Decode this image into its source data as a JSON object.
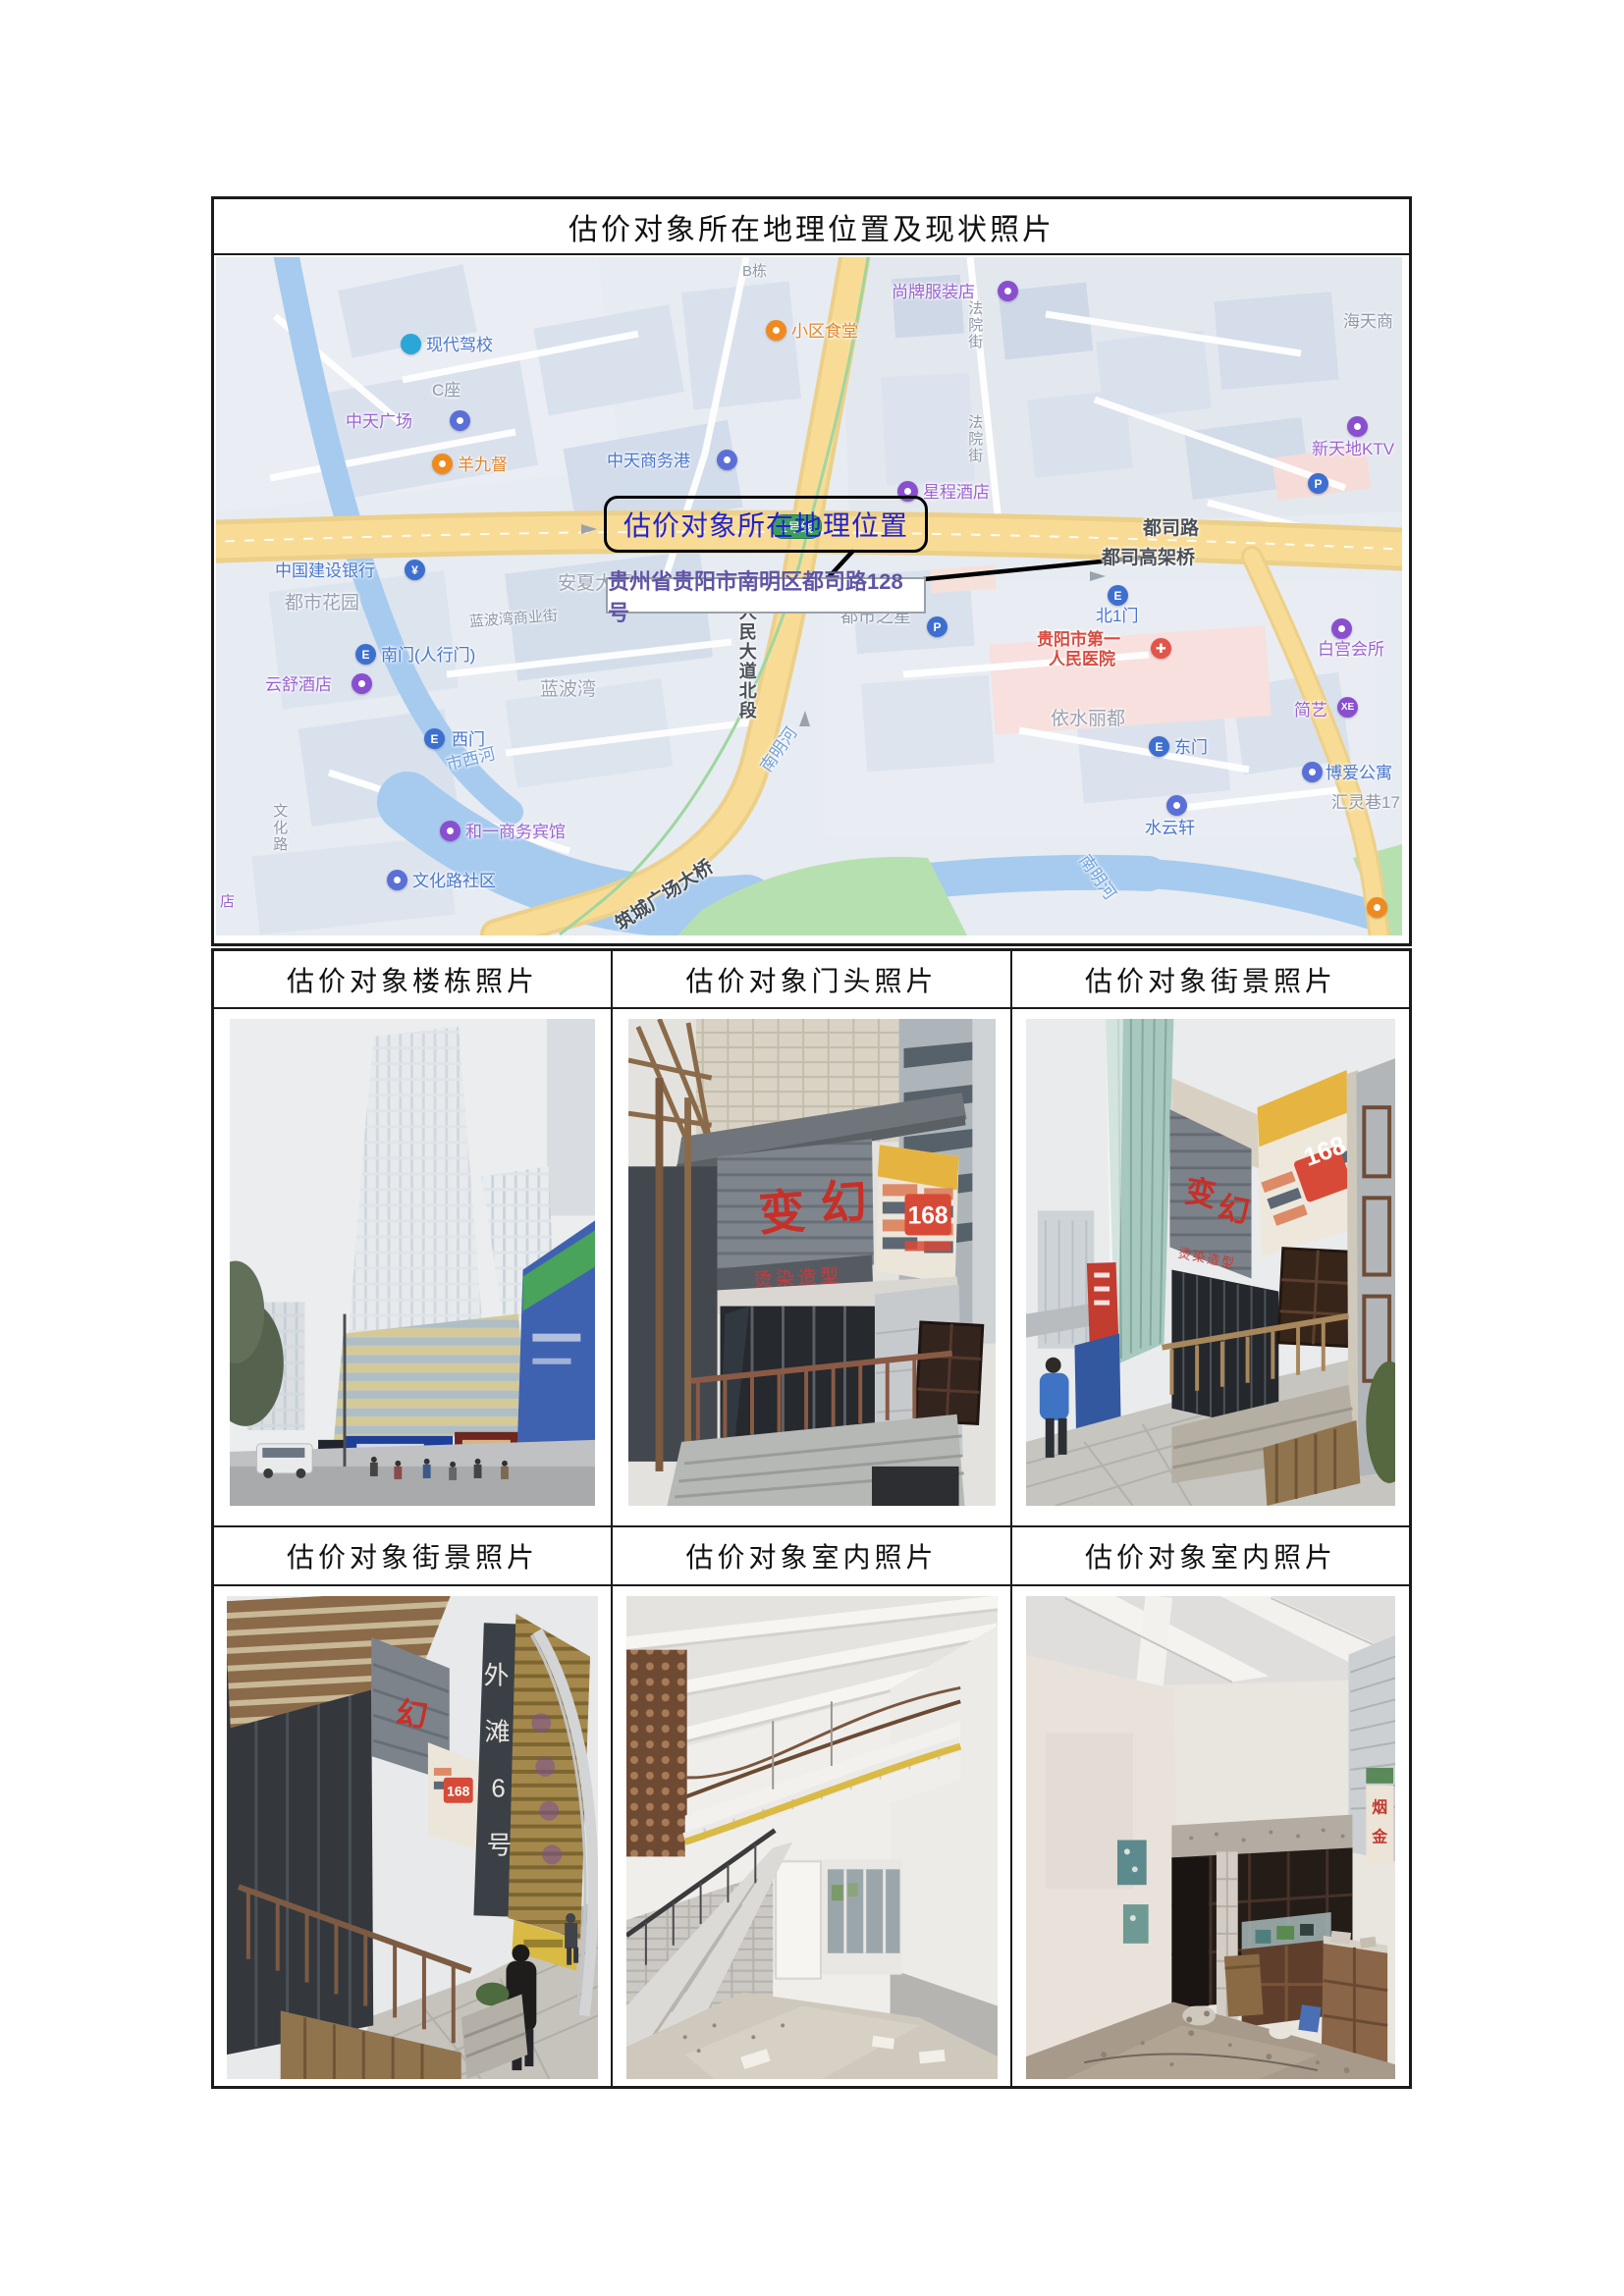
{
  "document": {
    "main_header": "估价对象所在地理位置及现状照片",
    "grid_headers_row1": [
      "估价对象楼栋照片",
      "估价对象门头照片",
      "估价对象街景照片"
    ],
    "grid_headers_row2": [
      "估价对象街景照片",
      "估价对象室内照片",
      "估价对象室内照片"
    ]
  },
  "map": {
    "callout_text": "估价对象所在地理位置",
    "pin_address": "贵州省贵阳市南明区都司路128号",
    "metro_badge": "1号线",
    "badge_xe": "XE",
    "badge_p": "P",
    "cross": "✚",
    "labels": {
      "xiandaijiaxiao": "现代驾校",
      "bdong": "B栋",
      "shangpai": "尚牌服装店",
      "xiaoqushitang": "小区食堂",
      "haitianshang": "海天商",
      "fayuanjie1": "法院街",
      "fayuanjie2": "法院街",
      "czuo": "C座",
      "zhongtianguangchang": "中天广场",
      "yangjiudu": "羊九督",
      "zhongtianshangwugang": "中天商务港",
      "xintiandiktv": "新天地KTV",
      "xingchengjiudian": "星程酒店",
      "dusilu": "都司路",
      "dusigaojiaqiao": "都司高架桥",
      "jianshebank": "中国建设银行",
      "anxiadasha": "安夏大厦",
      "dushihuayuan": "都市花园",
      "lanbowanshangyejie": "蓝波湾商业街",
      "nanmen": "南门(人行门)",
      "yunshujiudian": "云舒酒店",
      "lanbowan": "蓝波湾",
      "ximen": "西门",
      "shixihe": "市西河",
      "renmindadao": "人民大道北段",
      "dushizhixing": "都市之星",
      "bei1men": "北1门",
      "hospital1": "贵阳市第一",
      "hospital2": "人民医院",
      "yishulidu": "依水丽都",
      "dongmen": "东门",
      "baigonghuisuo": "白宫会所",
      "jianyi": "简艺",
      "boaigongyu": "博爱公寓",
      "huilingxiang": "汇灵巷17",
      "shuiyunxuan": "水云轩",
      "heyibinguan": "和一商务宾馆",
      "wenhualushequ": "文化路社区",
      "zhuchengbridge": "筑城广场大桥",
      "nanminghe1": "南明河",
      "nanminghe2": "南明河",
      "wenhualu": "文化路",
      "dian": "店"
    }
  },
  "photos": {
    "storefront": {
      "char1": "变",
      "char2": "幻",
      "sub": "烫染造型",
      "number": "168"
    },
    "street1": {
      "char1": "变",
      "char2": "幻",
      "sub": "烫染造型",
      "number": "168"
    },
    "street2": {
      "char1": "幻",
      "number": "168",
      "vchars": [
        "外",
        "滩",
        "6",
        "号"
      ]
    },
    "indoor2": {
      "poster_char1": "烟",
      "poster_char2": "金"
    }
  }
}
